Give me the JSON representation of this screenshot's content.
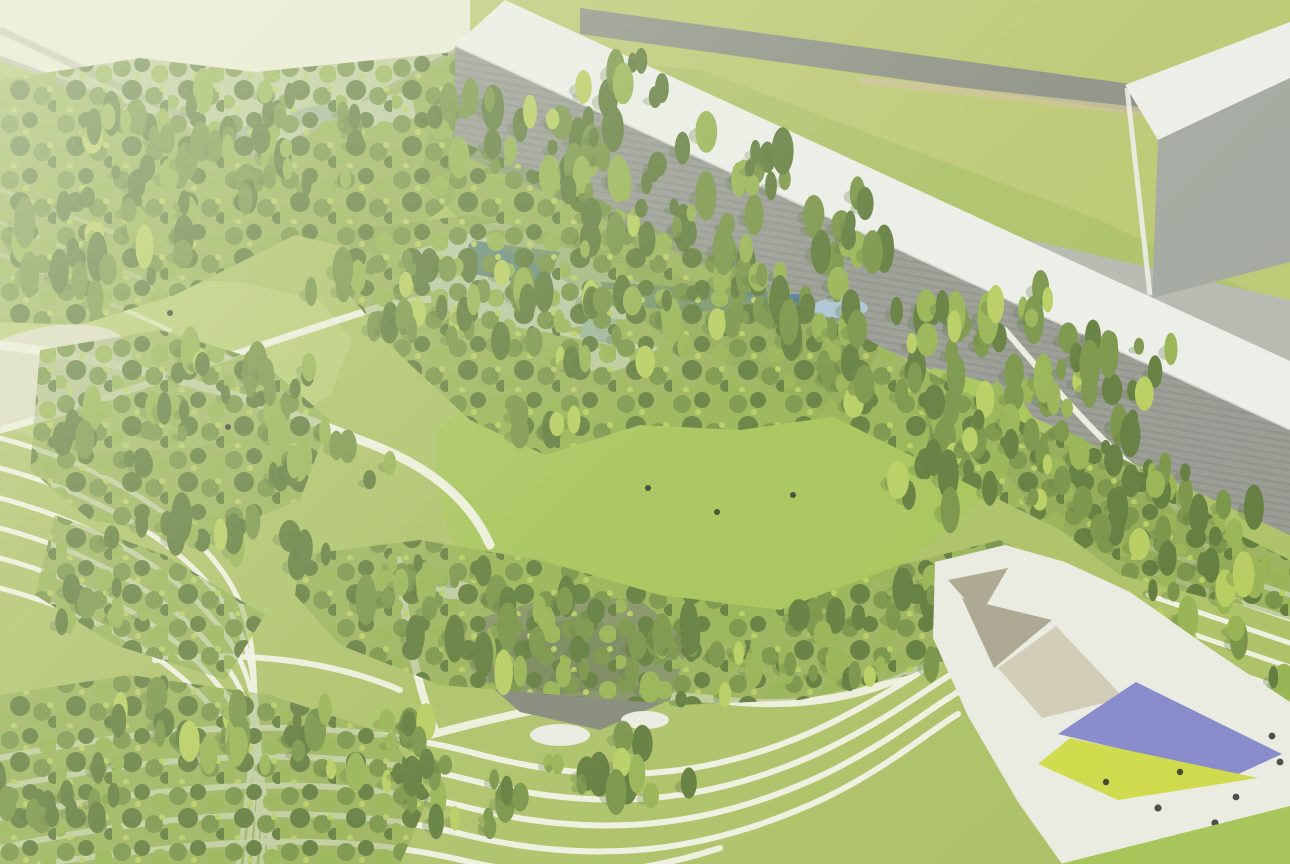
{
  "scene": {
    "type": "aerial-park-architectural-rendering",
    "palette": {
      "lawn_base": "#a7bd5d",
      "lawn_bright": "#9fc04d",
      "meadow": "#b3c86b",
      "upper_field": "#b6c468",
      "forest_floor": "#7d9a42",
      "tree_dark": "#55722f",
      "tree_mid": "#6e8c3a",
      "tree_light": "#8fae47",
      "tree_accent": "#b2ca55",
      "tree_shadow": "#49642c",
      "path_white": "#eff1e4",
      "terrace_line": "#f2f4e8",
      "plaza_white": "#e9ebe2",
      "road_dark": "#83877d",
      "road_tan": "#c8bd8d",
      "roof_white": "#eceeea",
      "facade_gray": "#8f938c",
      "building_face": "#9ba09a",
      "courtyard_gray": "#b0b3ab",
      "wall_pale": "#e9ecd9",
      "wall_edge": "#b5b9ab",
      "water_deep": "#416d9c",
      "water_light": "#a6c0d2",
      "pool_deck": "#dfe5e2",
      "rock_gray": "#7b7f70",
      "rock_dark": "#5f6357",
      "canopy_purple": "#7d81c9",
      "canopy_yellow": "#ccd83e",
      "sail_beige": "#cdc8b2",
      "sail_taupe": "#a59f8a",
      "roof_blue_gray": "#b3c1cb",
      "people_black": "#1c1f1c",
      "haze": "#eef2dc"
    },
    "features": [
      "industrial-hall-long",
      "industrial-hall-block",
      "perimeter-road",
      "upper-field",
      "forest-belts",
      "northwest-meadow",
      "great-lawn",
      "water-garden-with-arch",
      "rock-water-feature",
      "terraced-slopes",
      "event-plaza",
      "purple-canopy",
      "yellow-canopy",
      "shade-sails"
    ],
    "people": {
      "plaza_dots": 7,
      "lawn_dots": 5
    }
  }
}
